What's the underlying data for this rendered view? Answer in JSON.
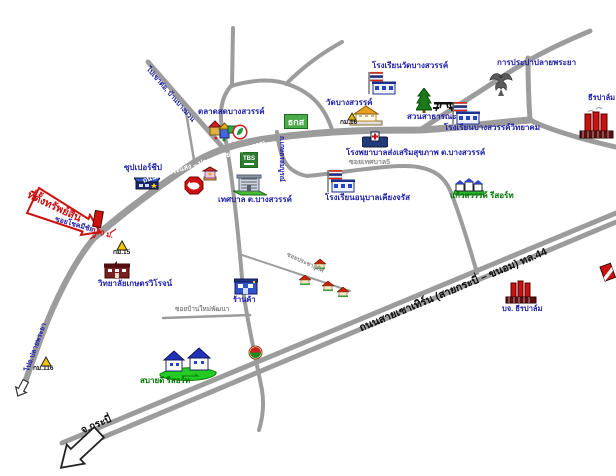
{
  "map": {
    "property": {
      "tag": "ที่ตั้งทรัพย์สิน",
      "distance": "100 ม.",
      "soi": "ซอยโชคมีชัย"
    },
    "roads": {
      "main_label": "ถนนสายพระแสง – ปลายพระยา (ทล.4009)",
      "highway_label": "ถนนสายเซาเทิร์น (สายกระบี่ – ขนอม) ทล.44",
      "to_krabi": "จ.กระบี่",
      "nw_road_label": "ไปเขาต่อ, บ้านบางมวน",
      "sw_road_label": "ไปอ.ปลายพระยา",
      "soi_tesaban5": "ซอยเทศบาล5",
      "soi_banmai": "ซอยบ้านใหม่พัฒนา",
      "soi_pracha": "ซอยประชาอุทิศ",
      "kaset_road": "ถ.เกษตรสมบูรณ์"
    },
    "places": {
      "market": "ตลาดสดบางสวรรค์",
      "supercheap": "ซุปเปอร์ชีป",
      "municipality": "เทศบาล ต.บางสวรรค์",
      "wat": "วัดบางสวรรค์",
      "school_wat": "โรงเรียนวัดบางสวรรค์",
      "park": "สวนสาธารณะ",
      "school_wittayakom": "โรงเรียนบางสวรรค์วิทยาคม",
      "waterworks": "การประปาปลายพระยา",
      "hospital": "โรงพยาบาลส่งเสริมสุขภาพ ต.บางสวรรค์",
      "school_anuban": "โรงเรียนอนุบาลเคียงจรัส",
      "resort_kaewsawan": "แก้วสวรรค์ รีสอร์ท",
      "resort_sabaidee": "สบายดี รีสอร์ท",
      "college": "วิทยาลัยเกษตรวิโรจน์",
      "shop": "ร้านค้า",
      "palm_factory_top": "ธีรปาล์ม",
      "palm_factory_co": "บจ. ธีรปาล์ม"
    },
    "markers": {
      "km15": "กม.15",
      "km16": "กม.16",
      "km116": "กม.116"
    },
    "signs": {
      "baac": "ธกส",
      "tbs": "TBS"
    },
    "colors": {
      "road_gray": "#9c9c9c",
      "label_blue": "#2222aa",
      "label_green": "#007700",
      "accent_red": "#cc1111",
      "sign_green": "#4bab4b"
    }
  }
}
